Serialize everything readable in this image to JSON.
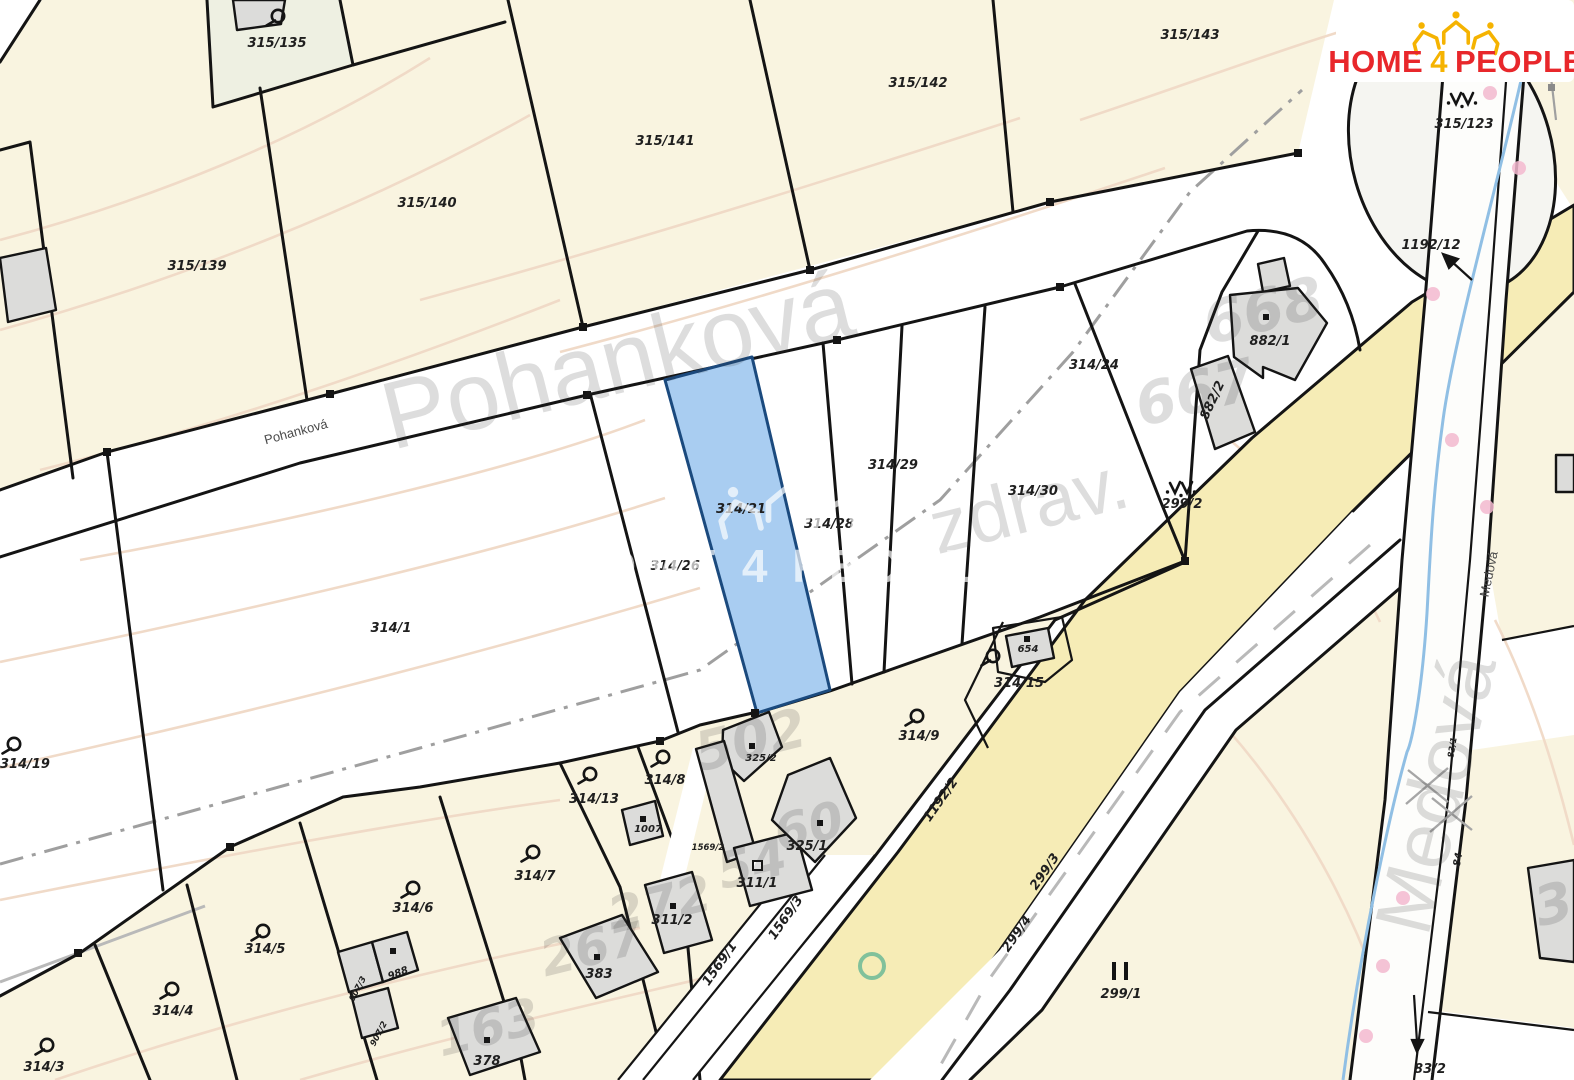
{
  "logo": {
    "home": "HOME",
    "four": "4",
    "people": "PEOPLE",
    "red": "#e8272b",
    "yellow": "#f5b301"
  },
  "watermark": {
    "brand": "HOME 4 PEOPLE"
  },
  "streets": {
    "pohankova": "Pohanková",
    "medova": "Medová",
    "zdrav": "zdrav."
  },
  "highlight": {
    "parcel": "314/21",
    "fill": "#a9cdf1",
    "border": "#1b4a7e"
  },
  "colors": {
    "land": "#f9f4e0",
    "road_yellow": "#f6ecb6",
    "building": "#dcdcda",
    "contour": "#f0d9c6",
    "stream": "#90bfe4",
    "pink_dot": "#f3b9cf",
    "green_ring": "#6cba97"
  },
  "parcels": {
    "p315_135": "315/135",
    "p315_139": "315/139",
    "p315_140": "315/140",
    "p315_141": "315/141",
    "p315_142": "315/142",
    "p315_143": "315/143",
    "p315_123": "315/123",
    "p1192_12": "1192/12",
    "p882_1": "882/1",
    "p882_2": "882/2",
    "p299_2": "299/2",
    "p314_24": "314/24",
    "p314_29": "314/29",
    "p314_30": "314/30",
    "p314_28": "314/28",
    "p314_21": "314/21",
    "p314_26": "314/26",
    "p314_1": "314/1",
    "p314_19": "314/19",
    "p654": "654",
    "p314_15": "314/15",
    "p314_9": "314/9",
    "p325_2": "325/2",
    "p314_8": "314/8",
    "p314_13": "314/13",
    "p1007": "1007",
    "p1569_2": "1569/2",
    "p325_1": "325/1",
    "p314_7": "314/7",
    "p311_1": "311/1",
    "p314_6": "314/6",
    "p311_2": "311/2",
    "p1569_3": "1569/3",
    "p1569_1": "1569/1",
    "p314_5": "314/5",
    "p383": "383",
    "p988": "988",
    "p907_3": "907/3",
    "p907_2": "907/2",
    "p314_4": "314/4",
    "p378": "378",
    "p314_3": "314/3",
    "p299_1": "299/1",
    "p299_3": "299/3",
    "p299_4": "299/4",
    "p1192_2": "1192/2",
    "p83_2": "83/2",
    "p84": "84",
    "p83_1": "83/1"
  },
  "base_numbers": {
    "n668": "668",
    "n667": "667",
    "n502": "502",
    "n60": "60",
    "n54": "54",
    "n272": "272",
    "n267": "267",
    "n163": "163",
    "n3": "3"
  }
}
